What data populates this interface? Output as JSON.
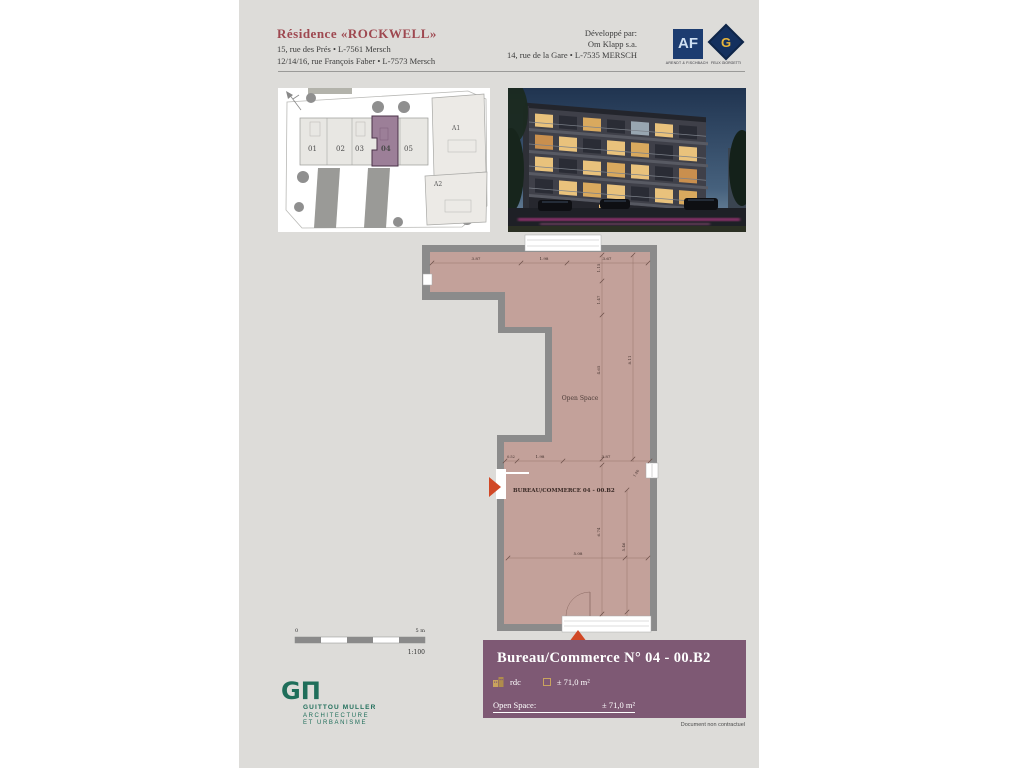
{
  "header": {
    "residence_title": "Résidence «ROCKWELL»",
    "address_line1": "15, rue des Prés • L-7561 Mersch",
    "address_line2": "12/14/16, rue François Faber • L-7573 Mersch",
    "developer_label": "Développé par:",
    "developer_name": "Om Klapp s.a.",
    "developer_address": "14, rue de la Gare • L-7535 MERSCH",
    "logo_af": {
      "monogram": "AF",
      "caption": "ARENDT & FISCHBACH"
    },
    "logo_g": {
      "monogram": "G",
      "caption": "FELIX GIORGETTI"
    }
  },
  "site_plan": {
    "units": [
      "01",
      "02",
      "03",
      "04",
      "05"
    ],
    "highlighted_unit": "04",
    "buildings": [
      "A1",
      "A2"
    ]
  },
  "floor_plan": {
    "room_label": "Open Space",
    "unit_label": "BUREAU/COMMERCE 04 - 00.B2",
    "dims_top": [
      "3.87",
      "1.98",
      "3.67"
    ],
    "dims_right": [
      "1.15",
      "1.47",
      "4.65",
      "8.11"
    ],
    "dims_mid": [
      "0.52",
      "1.98",
      "3.87",
      "1.40"
    ],
    "dims_lower": [
      "5.08",
      "6.74",
      "5.46"
    ]
  },
  "scale_bar": {
    "zero": "0",
    "five": "5 m",
    "ratio": "1:100"
  },
  "title_block": {
    "title": "Bureau/Commerce N° 04  -  00.B2",
    "floor_label": "rdc",
    "area_label": "± 71,0 m²",
    "open_space_label": "Open Space:",
    "open_space_area": "± 71,0 m²"
  },
  "architect": {
    "monogram": "GΠ",
    "name": "GUITTOU MULLER",
    "line1": "ARCHITECTURE",
    "line2": "ET URBANISME"
  },
  "footer": {
    "disclaimer": "Document non contractuel"
  },
  "colors": {
    "page_bg": "#dddcd9",
    "title_maroon": "#9e4850",
    "block_purple": "#7e5974",
    "unit_highlight": "#9c7f98",
    "plan_floor": "#c3a19a",
    "plan_wall": "#8b8b8b",
    "entrance_red": "#d14826",
    "architect_green": "#1f6e5a",
    "icon_gold": "#c9a35e",
    "logo_navy": "#1c3c70"
  }
}
